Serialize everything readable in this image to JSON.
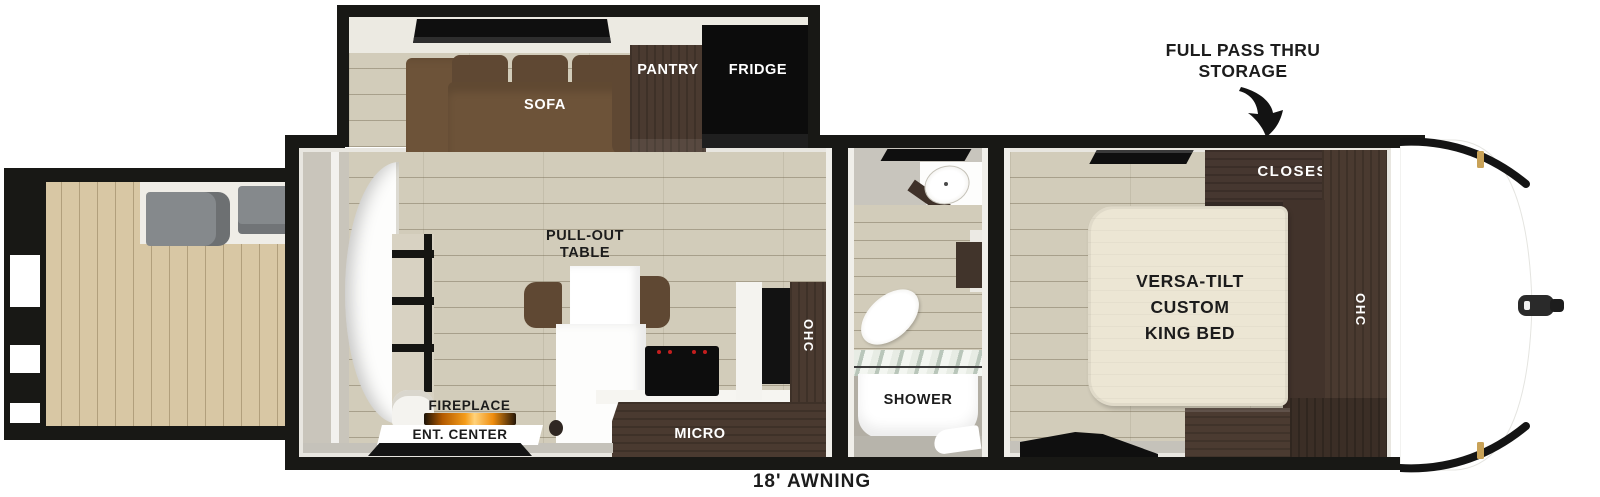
{
  "callout": {
    "storage_line1": "FULL PASS THRU",
    "storage_line2": "STORAGE"
  },
  "awning": {
    "label": "18' AWNING"
  },
  "living": {
    "sofa": "SOFA",
    "pantry": "PANTRY",
    "fridge": "FRIDGE",
    "pullout_line1": "PULL-OUT",
    "pullout_line2": "TABLE",
    "fireplace": "FIREPLACE",
    "ent_center": "ENT. CENTER",
    "micro": "MICRO",
    "ohc": "OHC"
  },
  "bathroom": {
    "shower": "SHOWER"
  },
  "bedroom": {
    "closet": "CLOSEST",
    "bed_line1": "VERSA-TILT",
    "bed_line2": "CUSTOM",
    "bed_line3": "KING BED",
    "ohc": "OHC"
  },
  "colors": {
    "wall": "#181815",
    "floor": "#d2ccba",
    "deck": "#d8c7a4",
    "sofa": "#6d5339",
    "sofadark": "#5f4833",
    "cab": "#4a3a30",
    "cabdark": "#3b2e26",
    "fridge": "#0c0c0c",
    "bed": "#ece6d4",
    "bathwall": "#b2aea4",
    "bench": "#85898c",
    "flame": "#f59d1a",
    "gold": "#c9a257",
    "graystrip": "#c5c2ba"
  }
}
